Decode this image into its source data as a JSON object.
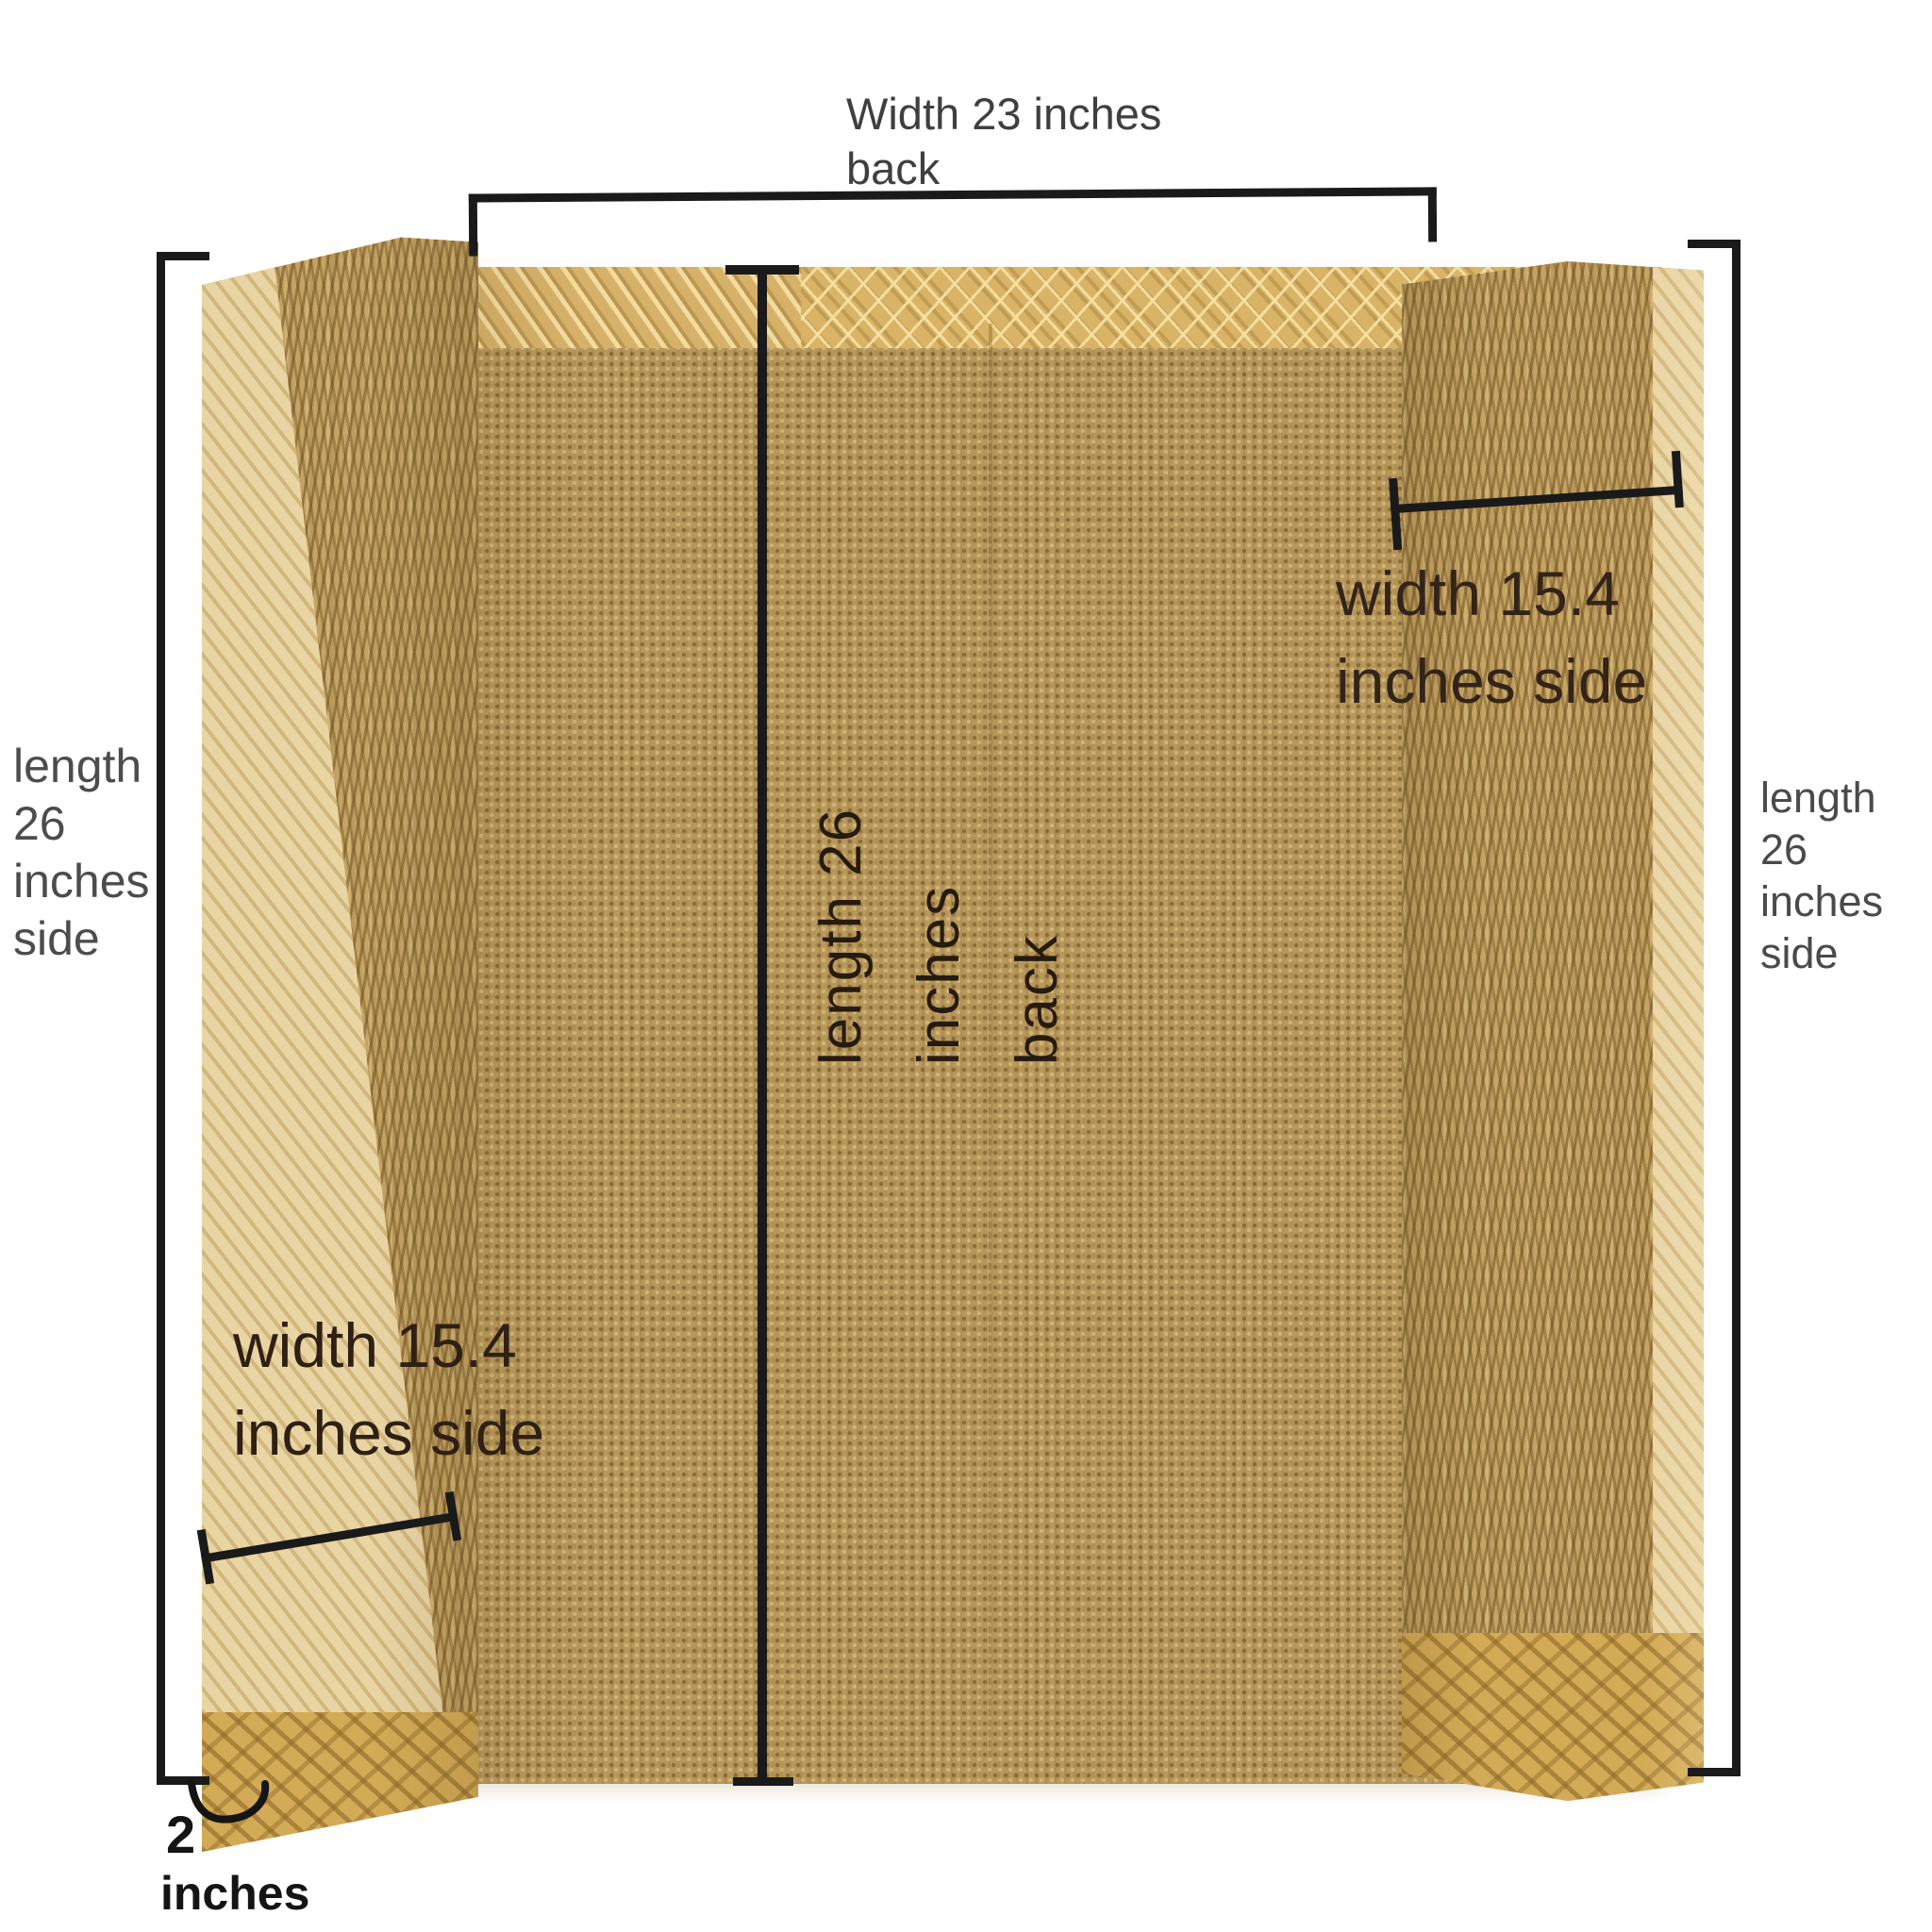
{
  "scene": {
    "subject": "Unfolded corrugated-cardboard pad: wide back panel with two narrow side panels, photographed on white with dimension annotations",
    "background": "#ffffff"
  },
  "annotations": {
    "back_width": {
      "line1": "Width 23 inches",
      "line2": "back"
    },
    "left_side_length": {
      "line1": "length",
      "line2": "26",
      "line3": "inches",
      "line4": "side"
    },
    "right_side_length": {
      "line1": "length",
      "line2": "26",
      "line3": "inches",
      "line4": "side"
    },
    "back_length": {
      "line1": "length 26",
      "line2": "inches",
      "line3": "back"
    },
    "upper_right_width": {
      "line1": "width 15.4",
      "line2": "inches side"
    },
    "lower_left_width": {
      "line1": "width 15.4",
      "line2": "inches side"
    },
    "thickness": {
      "value": "2",
      "unit": "inches"
    }
  },
  "colors": {
    "dimension_line": "#1a1a1a",
    "label_gray": "#4a4a4a",
    "label_dark_brown": "#2e2014",
    "cardboard_base": "#b7975a",
    "cardboard_herringbone": "#c4a363",
    "cardboard_light_edge": "#e9d5a4",
    "cardboard_lattice_strip": "#d9b466",
    "cardboard_bottom_cap": "#d3ab56"
  }
}
